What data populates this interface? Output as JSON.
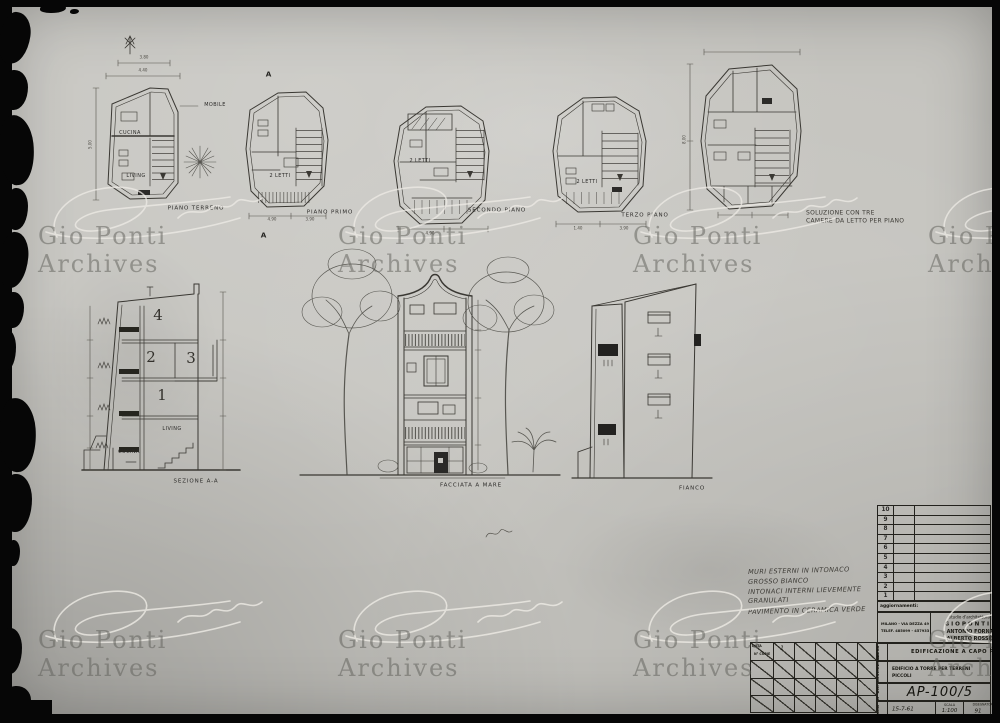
{
  "watermark": {
    "text": "Gio Ponti Archives"
  },
  "plans": {
    "caption_piano_terreno": "PIANO TERRENO",
    "caption_primo_piano": "PIANO PRIMO",
    "caption_secondo_piano": "SECONDO PIANO",
    "caption_terzo_piano": "TERZO PIANO",
    "note_line1": "SOLUZIONE CON TRE",
    "note_line2": "CAMERE DA LETTO PER PIANO",
    "label_cucina": "CUCINA",
    "label_living": "LIVING",
    "label_mobile": "MOBILE",
    "label_due_letti": "2 LETTI",
    "section_marker": "A"
  },
  "elevations": {
    "caption_sezione": "SEZIONE A-A",
    "caption_facciata": "FACCIATA A MARE",
    "caption_fianco": "FIANCO",
    "floor_4": "4",
    "floor_2": "2",
    "floor_3": "3",
    "floor_1": "1",
    "label_living": "LIVING",
    "label_cucina": "CUCINA"
  },
  "dims": {
    "d1": "3.80",
    "d2": "4.40",
    "d3": "5.00",
    "d4": "4.90",
    "d5": "3.90",
    "d6": "4.90",
    "d7": "1.40",
    "d8": "3.90",
    "d9": "8.00"
  },
  "notes": {
    "line1": "MURI ESTERNI IN INTONACO",
    "line2": "GROSSO BIANCO",
    "line3": "INTONACI INTERNI LIEVEMENTE",
    "line4": "GRANULATI",
    "line5": "PAVIMENTO IN CERAMICA VERDE"
  },
  "titleblock": {
    "revision_rows": [
      "10",
      "9",
      "8",
      "7",
      "6",
      "5",
      "4",
      "3",
      "2",
      "1"
    ],
    "aggiornamenti_label": "aggiornamenti:",
    "studio_line": "studio d'architettura",
    "architect_1": "G I O   P O N T I",
    "architect_2": "ANTONIO FORNAROLI",
    "architect_3": "ALBERTO ROSSELLI",
    "address_1": "MILANO - VIA DEZZA 49",
    "address_2": "TELEF. 485099 - 457933",
    "opera_label": "OPERA",
    "opera_value": "EDIFICAZIONE A CAPO PERLA",
    "descrizione_label": "DESCRIZIONE",
    "descrizione_value_1": "EDIFICIO A TORRE PER TERRENI",
    "descrizione_value_2": "PICCOLI",
    "dis_label": "N° DIS.",
    "dis_value": "AP-100/5",
    "data_label": "DATA",
    "data_value": "15-7-61",
    "scala_label": "SCALA",
    "scala_value": "1:100",
    "disegnatore_label": "DISEGNATORE",
    "disegnatore_value": "91",
    "copies_header_1": "DATA",
    "copies_header_2": "N° COPIE",
    "copies_value": "1"
  }
}
